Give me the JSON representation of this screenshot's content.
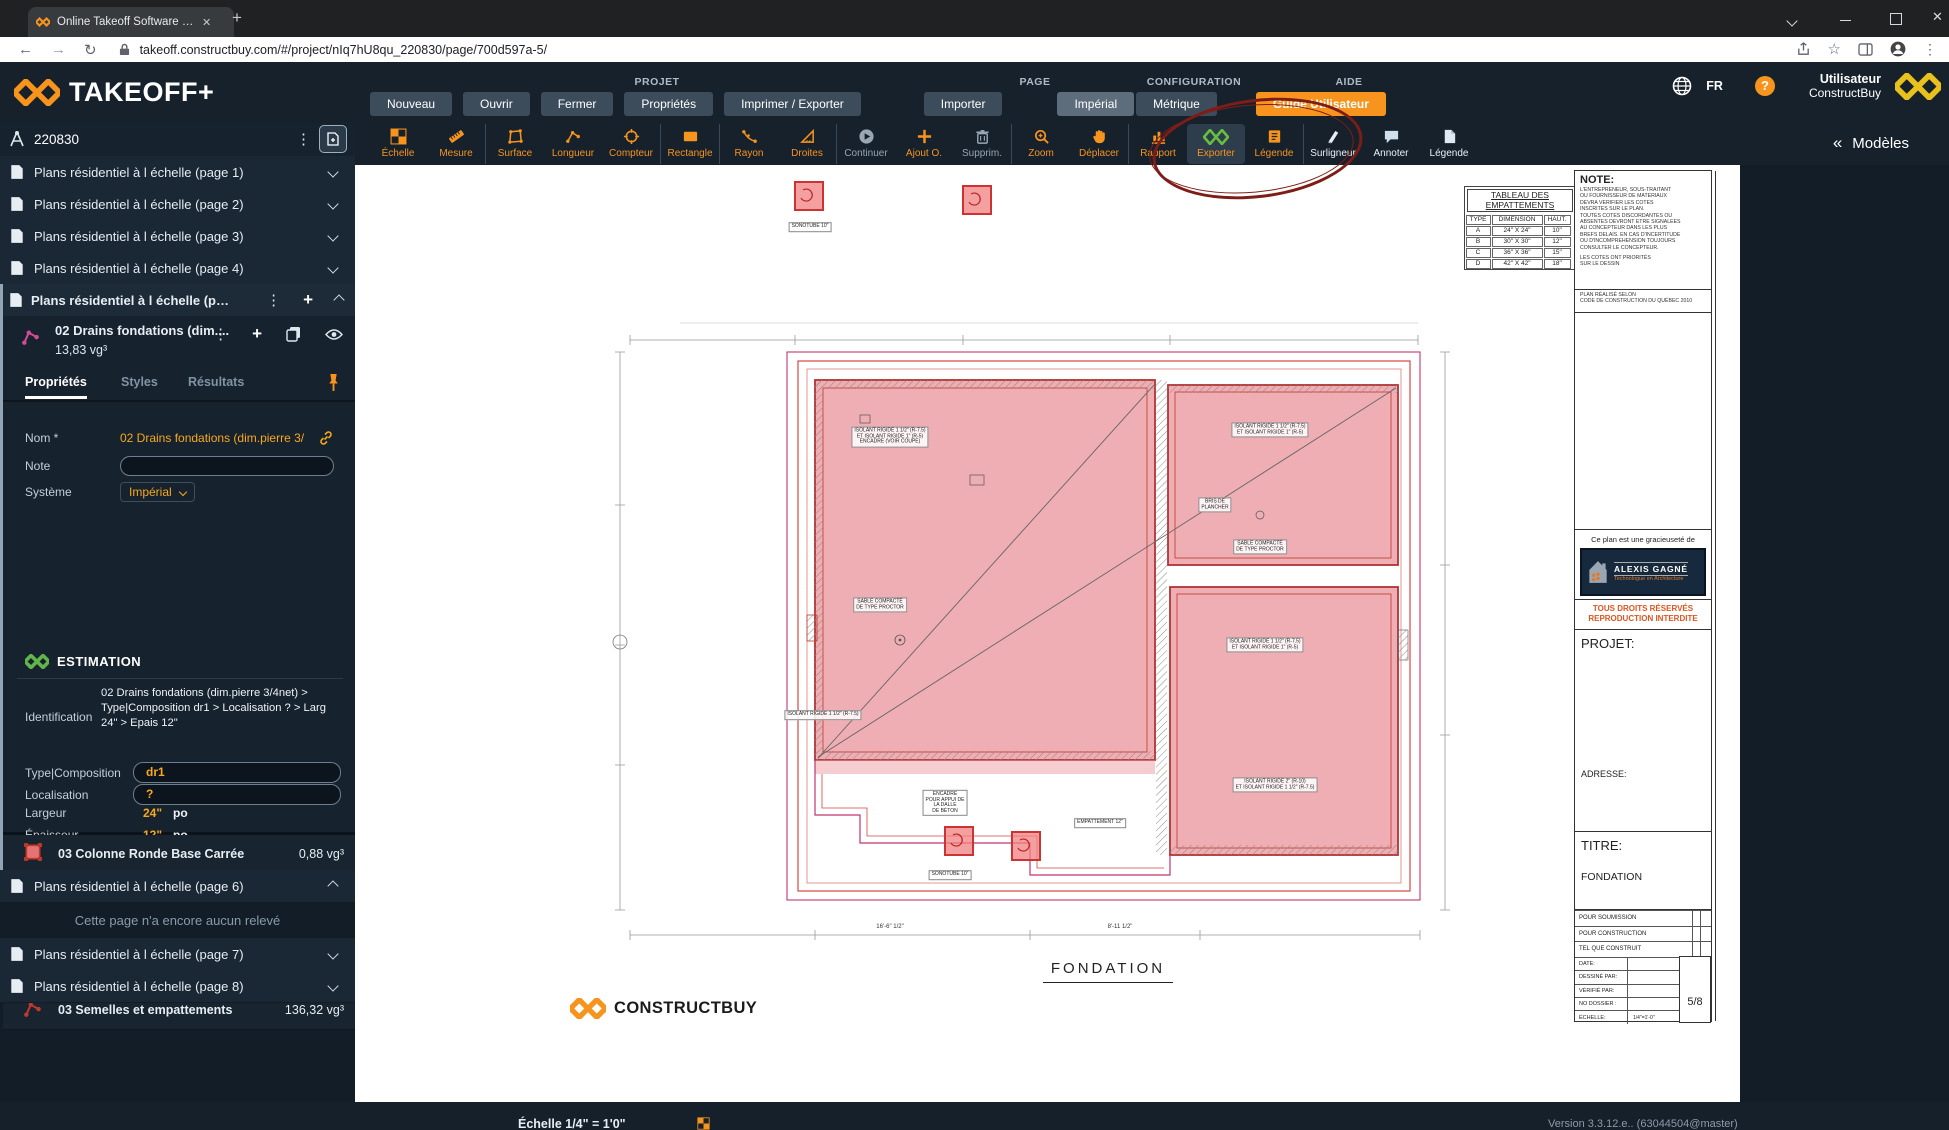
{
  "browser": {
    "tab_title": "Online Takeoff Software | Takeoff",
    "url": "takeoff.constructbuy.com/#/project/nIq7hU8qu_220830/page/700d597a-5/"
  },
  "header": {
    "logo_text": "TAKEOFF+",
    "categories": {
      "projet": "PROJET",
      "page": "PAGE",
      "configuration": "CONFIGURATION",
      "aide": "AIDE"
    },
    "menu": {
      "nouveau": "Nouveau",
      "ouvrir": "Ouvrir",
      "fermer": "Fermer",
      "proprietes": "Propriétés",
      "imprimer": "Imprimer / Exporter",
      "importer": "Importer",
      "imperial": "Impérial",
      "metrique": "Métrique",
      "guide": "Guide Utilisateur"
    },
    "lang": "FR",
    "user_line1": "Utilisateur",
    "user_line2": "ConstructBuy"
  },
  "toolbar": {
    "models_label": "Modèles",
    "guillemet": "«",
    "tools": [
      {
        "id": "echelle",
        "label": "Échelle",
        "icon": "checker",
        "cls": ""
      },
      {
        "id": "mesure",
        "label": "Mesure",
        "icon": "ruler",
        "cls": "sep"
      },
      {
        "id": "surface",
        "label": "Surface",
        "icon": "surface",
        "cls": ""
      },
      {
        "id": "longueur",
        "label": "Longueur",
        "icon": "longueur",
        "cls": ""
      },
      {
        "id": "compteur",
        "label": "Compteur",
        "icon": "compteur",
        "cls": "sep"
      },
      {
        "id": "rectangle",
        "label": "Rectangle",
        "icon": "rectangle",
        "cls": "sep"
      },
      {
        "id": "rayon",
        "label": "Rayon",
        "icon": "rayon",
        "cls": ""
      },
      {
        "id": "droites",
        "label": "Droites",
        "icon": "droites",
        "cls": "sep"
      },
      {
        "id": "continuer",
        "label": "Continuer",
        "icon": "continuer",
        "cls": "muted"
      },
      {
        "id": "ajout-o",
        "label": "Ajout O.",
        "icon": "ajout",
        "cls": ""
      },
      {
        "id": "supprim",
        "label": "Supprim.",
        "icon": "supprim",
        "cls": "muted sep"
      },
      {
        "id": "zoom",
        "label": "Zoom",
        "icon": "zoom",
        "cls": ""
      },
      {
        "id": "deplacer",
        "label": "Déplacer",
        "icon": "deplacer",
        "cls": "sep"
      },
      {
        "id": "rapport",
        "label": "Rapport",
        "icon": "rapport",
        "cls": ""
      },
      {
        "id": "exporter",
        "label": "Exporter",
        "icon": "exporter",
        "cls": "active"
      },
      {
        "id": "legende",
        "label": "Légende",
        "icon": "legende",
        "cls": "sep"
      },
      {
        "id": "surligneur",
        "label": "Surligneur",
        "icon": "surligneur",
        "cls": "light"
      },
      {
        "id": "annoter",
        "label": "Annoter",
        "icon": "annoter",
        "cls": "light"
      },
      {
        "id": "legende-2",
        "label": "Légende",
        "icon": "legende2",
        "cls": "light"
      }
    ]
  },
  "sidebar": {
    "project_number": "220830",
    "pages_top": [
      {
        "id": "page-1",
        "label": "Plans résidentiel à l échelle (page 1)"
      },
      {
        "id": "page-2",
        "label": "Plans résidentiel à l échelle (page 2)"
      },
      {
        "id": "page-3",
        "label": "Plans résidentiel à l échelle (page 3)"
      },
      {
        "id": "page-4",
        "label": "Plans résidentiel à l échelle (page 4)"
      }
    ],
    "active_page_label": "Plans résidentiel à l échelle (pa...",
    "measurement": {
      "name": "02 Drains fondations (dim....",
      "quantity": "13,83 vg³",
      "tabs": {
        "proprietes": "Propriétés",
        "styles": "Styles",
        "resultats": "Résultats"
      },
      "nom_label": "Nom *",
      "nom_value": "02 Drains fondations (dim.pierre 3/",
      "note_label": "Note",
      "systeme_label": "Système",
      "systeme_value": "Impérial",
      "estimation_title": "ESTIMATION",
      "identification_label": "Identification",
      "identification_value": "02 Drains fondations (dim.pierre 3/4net) >\nType|Composition dr1 > Localisation ? > Larg\n24\" > Epais 12\"",
      "type_label": "Type|Composition",
      "type_value": "dr1",
      "localisation_label": "Localisation",
      "localisation_value": "?",
      "largeur_label": "Largeur",
      "largeur_value": "24\"",
      "largeur_unit": "po",
      "epaisseur_label": "Épaisseur",
      "epaisseur_value": "12\"",
      "epaisseur_unit": "po"
    },
    "measurements": [
      {
        "id": "colonne",
        "name": "03 Colonne Ronde Base Carrée",
        "value": "0,88 vg³",
        "icon": "rectfill"
      },
      {
        "id": "dalle-1",
        "name": "03 Dalle de béton",
        "value": "6,38 vg³",
        "icon": "rectoutline"
      },
      {
        "id": "dalle-2",
        "name": "03 Dalle de béton",
        "value": "13,31 vg³",
        "icon": "rectoutline"
      },
      {
        "id": "mur",
        "name": "03 Mur de fondation au pi/lin",
        "value": "36,74 vg³",
        "icon": "polyred"
      },
      {
        "id": "semelles",
        "name": "03 Semelles et empattements",
        "value": "136,32 vg³",
        "icon": "polyred"
      }
    ],
    "page6_label": "Plans résidentiel à l échelle (page 6)",
    "empty_message": "Cette page n'a encore aucun relevé",
    "pages_bottom": [
      {
        "id": "page-7",
        "label": "Plans résidentiel à l échelle (page 7)"
      },
      {
        "id": "page-8",
        "label": "Plans résidentiel à l échelle (page 8)"
      }
    ],
    "status": {
      "ready_text": "Relevé prêt à exporter vers",
      "estimation": "ESTIMATION"
    }
  },
  "statusbar": {
    "scale_label": "Échelle 1/4\" = 1'0\"",
    "version": "Version 3.3.12.e.. (63044504@master)"
  },
  "canvas": {
    "plan_title": "FONDATION",
    "brand": "CONSTRUCTBUY",
    "tableau": {
      "title": "TABLEAU DES\nEMPATTEMENTS",
      "headers": {
        "type": "TYPE",
        "dimension": "DIMENSION",
        "haut": "HAUT."
      },
      "rows": [
        {
          "type": "A",
          "dim": "24\" X 24\"",
          "haut": "10\""
        },
        {
          "type": "B",
          "dim": "30\" X 30\"",
          "haut": "12\""
        },
        {
          "type": "C",
          "dim": "36\" X 36\"",
          "haut": "15\""
        },
        {
          "type": "D",
          "dim": "42\" X 42\"",
          "haut": "18\""
        }
      ]
    },
    "titleblock": {
      "note_title": "NOTE:",
      "note_body": "L'ENTREPRENEUR, SOUS-TRAITANT\nOU FOURNISSEUR DE MATERIAUX\nDEVRA VERIFIER LES COTES\nINSCRITES SUR LE PLAN.\nTOUTES COTES DISCORDANTES OU\nABSENTES DEVRONT ETRE SIGNALEES\nAU CONCEPTEUR DANS LES PLUS\nBREFS DELAIS. EN CAS D'INCERTITUDE\nOU D'INCOMPREHENSION TOUJOURS\nCONSULTER LE CONCEPTEUR.",
      "note_footer": "LES COTES ONT PRIORITÉS\nSUR LE DESSIN",
      "plan_selon": "PLAN RÉALISÉ SELON\nCODE DE CONSTRUCTION DU QUÉBEC 2010",
      "gracieusete": "Ce plan est une gracieuseté de",
      "logo_name": "ALEXIS GAGNÉ",
      "logo_tagline": "Technologue en Architecture",
      "rights": "TOUS DROITS RÉSERVÉS\nREPRODUCTION INTERDITE",
      "projet_label": "PROJET:",
      "adresse_label": "ADRESSE:",
      "titre_label": "TITRE:",
      "titre_value": "FONDATION",
      "check_rows": [
        {
          "label": "POUR SOUMISSION"
        },
        {
          "label": "POUR CONSTRUCTION"
        },
        {
          "label": "TEL QUE CONSTRUIT"
        }
      ],
      "info_rows": [
        {
          "label": "DATE:",
          "value": ""
        },
        {
          "label": "DESSINÉ PAR:",
          "value": ""
        },
        {
          "label": "VÉRIFIÉ PAR:",
          "value": ""
        },
        {
          "label": "NO DOSSIER :",
          "value": ""
        },
        {
          "label": "ÉCHELLE:",
          "value": "1/4\"=1'-0\""
        }
      ],
      "sheet_number": "5/8"
    },
    "annotations": [
      {
        "x": 250,
        "y": 52,
        "text": "SONOTUBE 10\""
      },
      {
        "x": 330,
        "y": 262,
        "text": "ISOLANT RIGIDE 1 1/2\" (R-7.5)\nET ISOLANT RIGIDE 1\" (R-5)\nENCADRE (VOIR COUPE)"
      },
      {
        "x": 320,
        "y": 430,
        "text": "SABLE COMPACTÉ\nDE TYPE PROCTOR"
      },
      {
        "x": 710,
        "y": 255,
        "text": "ISOLANT RIGIDE 1 1/2\" (R-7.5)\nET ISOLANT RIGIDE 1\" (R-5)"
      },
      {
        "x": 655,
        "y": 330,
        "text": "BRIS DE\nPLANCHER"
      },
      {
        "x": 700,
        "y": 372,
        "text": "SABLE COMPACTÉ\nDE TYPE PROCTOR"
      },
      {
        "x": 705,
        "y": 470,
        "text": "ISOLANT RIGIDE 1 1/2\" (R-7.5)\nET ISOLANT RIGIDE 1\" (R-5)"
      },
      {
        "x": 715,
        "y": 610,
        "text": "ISOLANT RIGIDE 2\" (R-10)\nET ISOLANT RIGIDE 1 1/2\" (R-7.5)"
      },
      {
        "x": 540,
        "y": 648,
        "text": "EMPATTEMENT 12\""
      },
      {
        "x": 385,
        "y": 628,
        "text": "ENCADRE\nPOUR APPUI DE\nLA DALLE\nDE BÉTON"
      },
      {
        "x": 390,
        "y": 700,
        "text": "SONOTUBE 10\""
      },
      {
        "x": 263,
        "y": 540,
        "text": "ISOLANT RIGIDE 1 1/2\" (R-7.5)"
      }
    ],
    "dim_labels": [
      {
        "x": 330,
        "y": 752,
        "text": "16'-6\" 1/2\""
      },
      {
        "x": 560,
        "y": 752,
        "text": "8'-11 1/2\""
      }
    ]
  }
}
